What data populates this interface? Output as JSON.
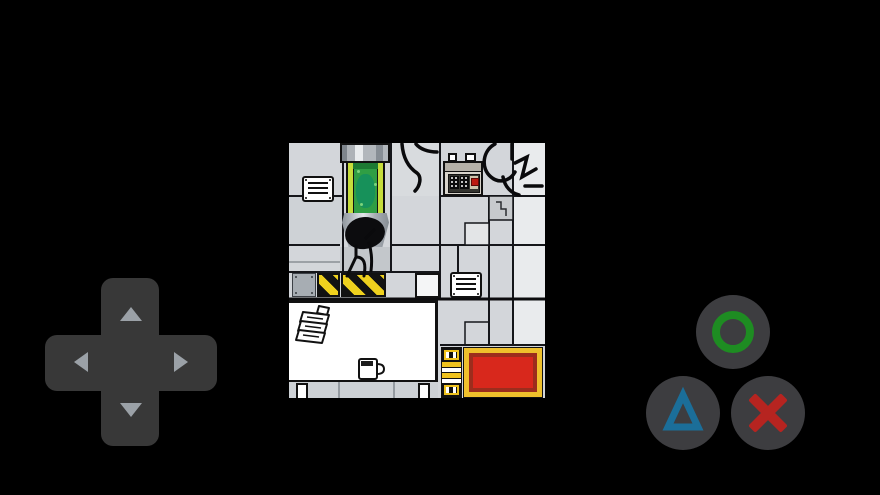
{
  "app": {
    "kind": "touchscreen game with on-screen gamepad",
    "background_color": "#000000"
  },
  "game_screen": {
    "description": "pixel-art laboratory room",
    "objects": [
      "cloning-tube-machine with green fluid",
      "black-headed stick figure standing under tube",
      "wall vent grille upper-left",
      "wall vent grille lower-right",
      "control panel with red button and static displays",
      "black cable scribbles on upper wall",
      "yellow-black hazard stripe strip",
      "riveted grey wall plate",
      "white desk with paper stack and coffee mug",
      "yellow striped post",
      "red mat with yellow border"
    ],
    "colors": {
      "wall_tile": "#d3d6da",
      "wall_tile_light": "#e9ebed",
      "outline": "#111111",
      "tube_fluid": "#2f9e44",
      "tube_rail": "#c6dd3c",
      "hazard_yellow": "#efd11e",
      "desk": "#ffffff",
      "mat_red": "#d8281c",
      "mat_border_yellow": "#efc02c",
      "mat_ring_maroon": "#9c2d1d",
      "post_yellow": "#efc21e",
      "panel_button_red": "#bd1a10"
    }
  },
  "controls": {
    "dpad": {
      "pad_color": "#383838",
      "arrow_color": "#9ba1a7",
      "up_label": "D-pad up",
      "down_label": "D-pad down",
      "left_label": "D-pad left",
      "right_label": "D-pad right"
    },
    "action_buttons": {
      "button_face_color": "#3d3d40",
      "circle": {
        "symbol": "circle",
        "color": "#1e8c22",
        "label": "Circle button"
      },
      "triangle": {
        "symbol": "triangle",
        "color": "#1b6e99",
        "label": "Triangle button"
      },
      "cross": {
        "symbol": "cross",
        "color": "#b62420",
        "label": "Cross button"
      }
    }
  }
}
